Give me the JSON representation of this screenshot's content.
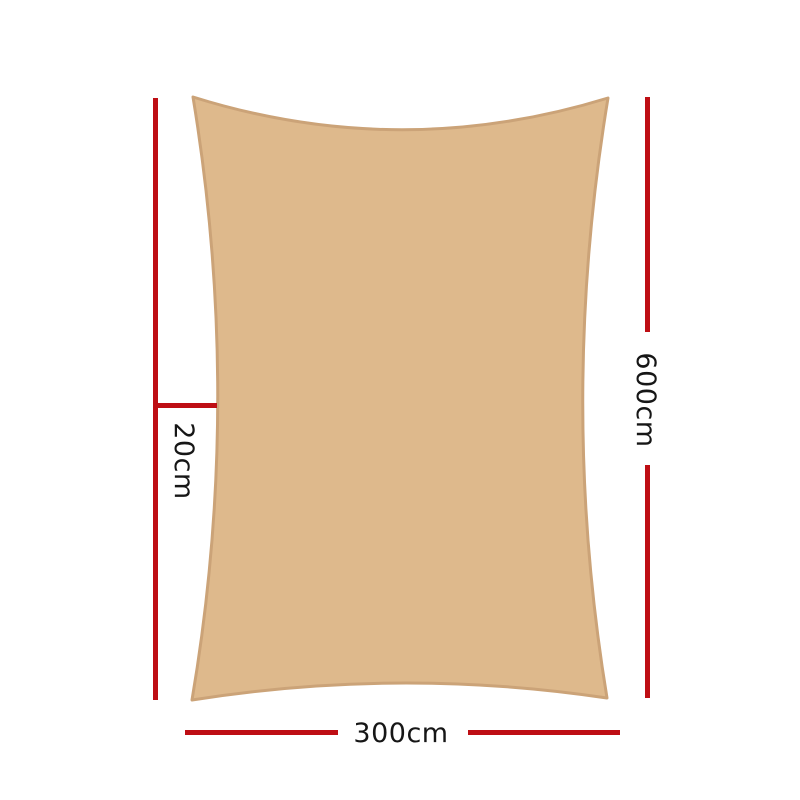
{
  "diagram": {
    "type": "product-dimension-diagram",
    "product": "shade-sail-rectangle",
    "background": "#FFFFFF",
    "colors": {
      "dimension_red": "#BE0E14",
      "sail_fill": "#DEB98C",
      "sail_stroke": "#CBA378",
      "label_text": "#161616"
    },
    "labels": {
      "offset": "20cm",
      "height": "600cm",
      "width": "300cm"
    },
    "dimensions": [
      {
        "id": "offset",
        "value": "20cm",
        "orientation": "vertical",
        "side": "left"
      },
      {
        "id": "height",
        "value": "600cm",
        "orientation": "vertical",
        "side": "right"
      },
      {
        "id": "width",
        "value": "300cm",
        "orientation": "horizontal",
        "side": "bottom"
      }
    ]
  }
}
